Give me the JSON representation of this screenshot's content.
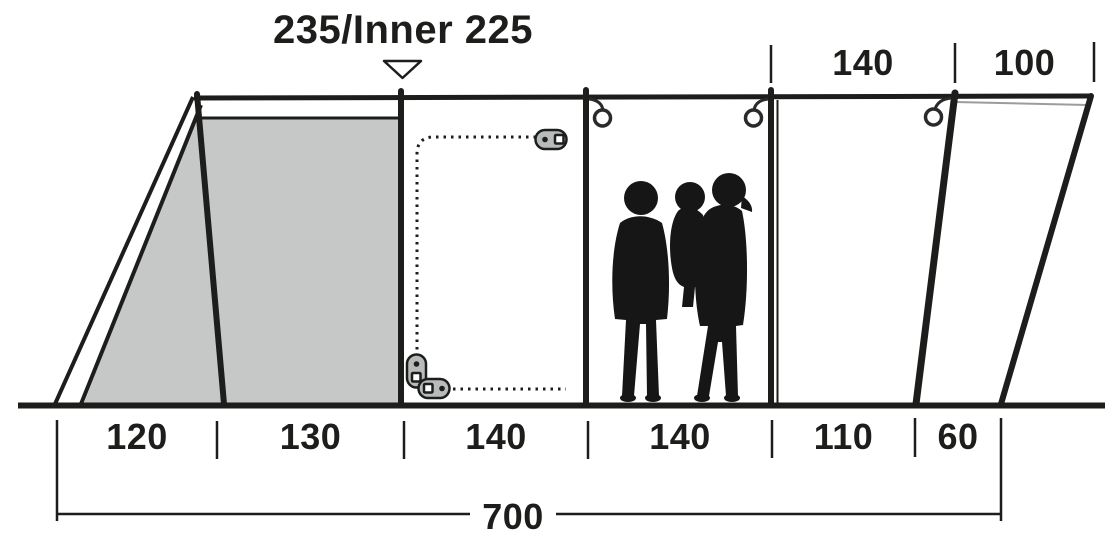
{
  "title": {
    "label": "235/Inner 225"
  },
  "marker": {
    "icon": "triangle-down-marker"
  },
  "dimensions_top": [
    {
      "label": "140",
      "value": 140
    },
    {
      "label": "100",
      "value": 100
    }
  ],
  "dimensions_bottom": [
    {
      "label": "120",
      "value": 120
    },
    {
      "label": "130",
      "value": 130
    },
    {
      "label": "140",
      "value": 140
    },
    {
      "label": "140",
      "value": 140
    },
    {
      "label": "110",
      "value": 110
    },
    {
      "label": "60",
      "value": 60
    }
  ],
  "dimensions_total": {
    "label": "700",
    "value": 700
  },
  "icons": {
    "hooks": "ring-hook-icon",
    "zipper_pulls": "zipper-pull-icon",
    "door_seam": "dotted-zipper-line",
    "people": "family-silhouette"
  },
  "colors": {
    "line": "#1d1d1b",
    "inner_tent_fill": "#c5c8c7",
    "hardware_fill": "#b7bbba",
    "silhouette": "#161616",
    "background": "#ffffff"
  }
}
